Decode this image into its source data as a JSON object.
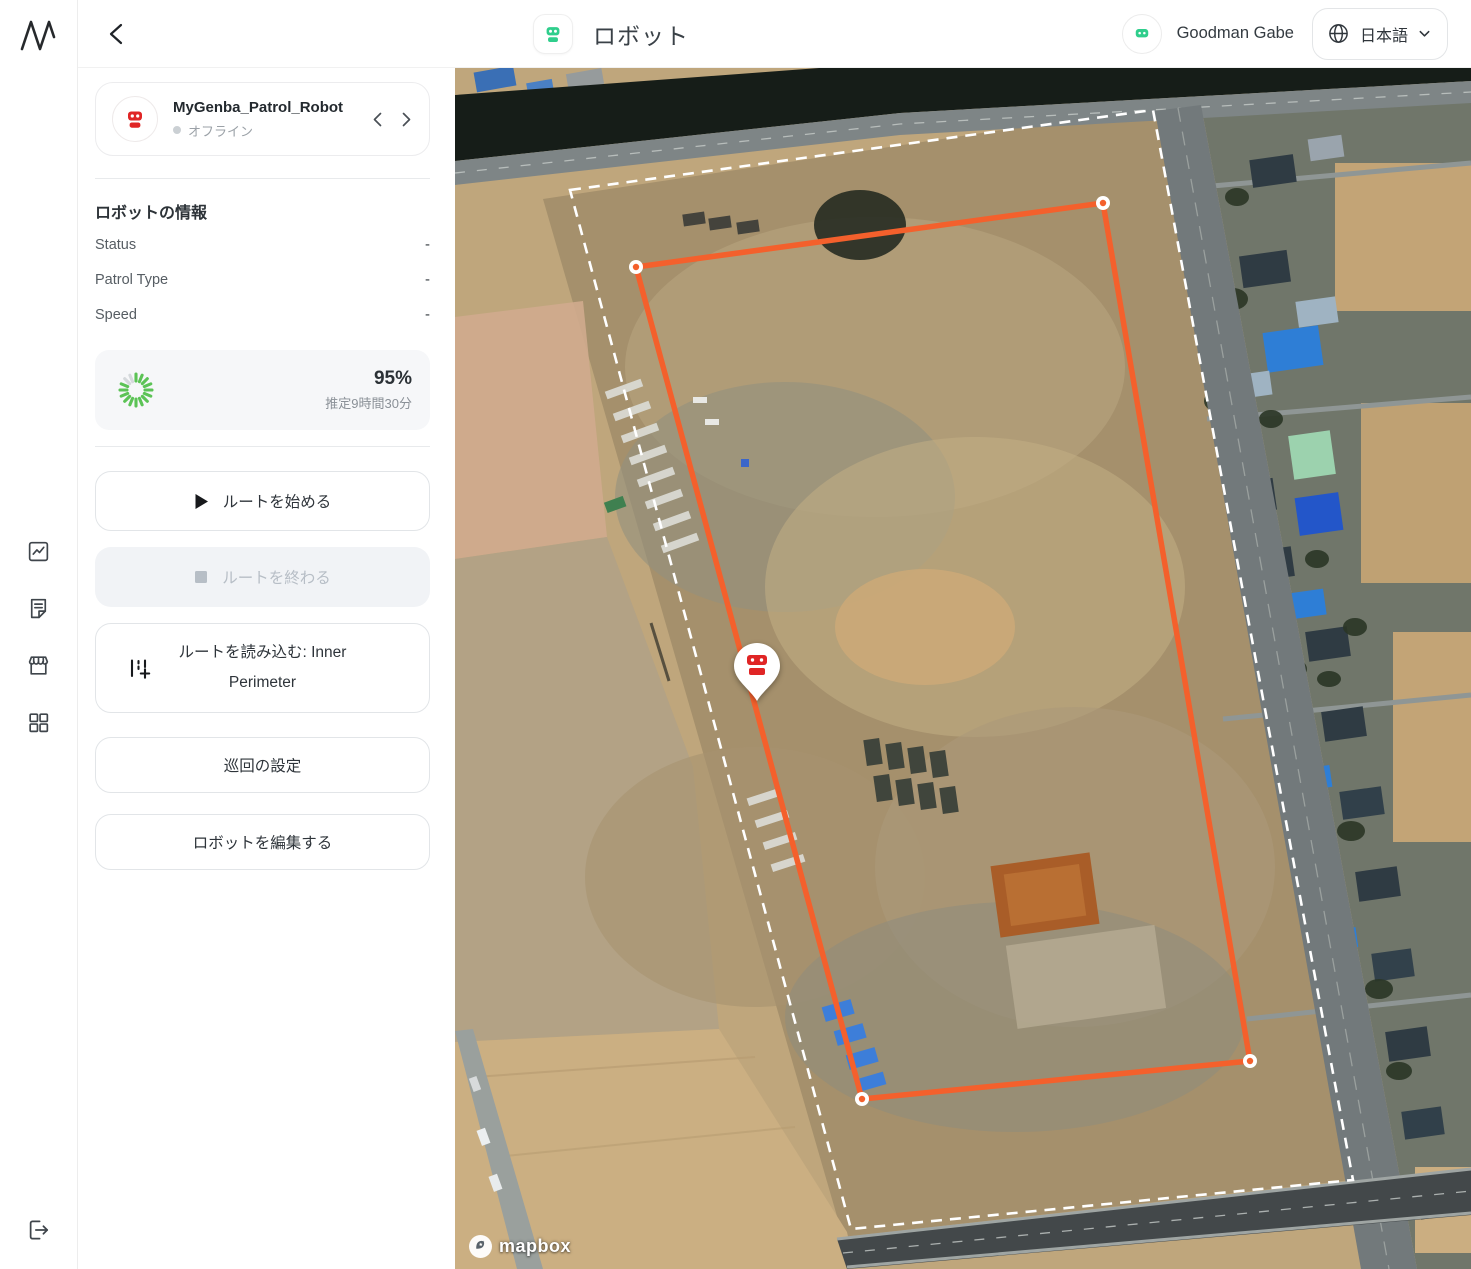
{
  "app": {
    "logo_letter": "M"
  },
  "header": {
    "title": "ロボット",
    "user_name": "Goodman Gabe",
    "language_label": "日本語"
  },
  "icons": {
    "rail": [
      "chart-icon",
      "report-icon",
      "storefront-icon",
      "grid-icon"
    ],
    "rail_bottom": "logout-icon",
    "header": [
      "back-icon",
      "robot-icon",
      "globe-icon",
      "chevron-down-icon"
    ],
    "map": [
      "robot-pin",
      "mapbox-logo-icon"
    ]
  },
  "robot_panel": {
    "name": "MyGenba_Patrol_Robot",
    "status": "オフライン",
    "info_title": "ロボットの情報",
    "info_rows": [
      {
        "label": "Status",
        "value": "-"
      },
      {
        "label": "Patrol Type",
        "value": "-"
      },
      {
        "label": "Speed",
        "value": "-"
      }
    ],
    "battery": {
      "percent": "95%",
      "estimate": "推定9時間30分"
    },
    "actions": {
      "start": "ルートを始める",
      "stop": "ルートを終わる",
      "load_route": "ルートを読み込む: Inner Perimeter",
      "patrol_settings": "巡回の設定",
      "edit_robot": "ロボットを編集する"
    }
  },
  "map": {
    "attribution": "mapbox",
    "route_name": "Inner Perimeter",
    "route_color": "#F4602C",
    "boundary_color": "#FFFFFF"
  },
  "colors": {
    "accent_green": "#2FCE8C",
    "robot_red": "#E02525",
    "route_orange": "#F4602C",
    "battery_green": "#5CC356"
  }
}
